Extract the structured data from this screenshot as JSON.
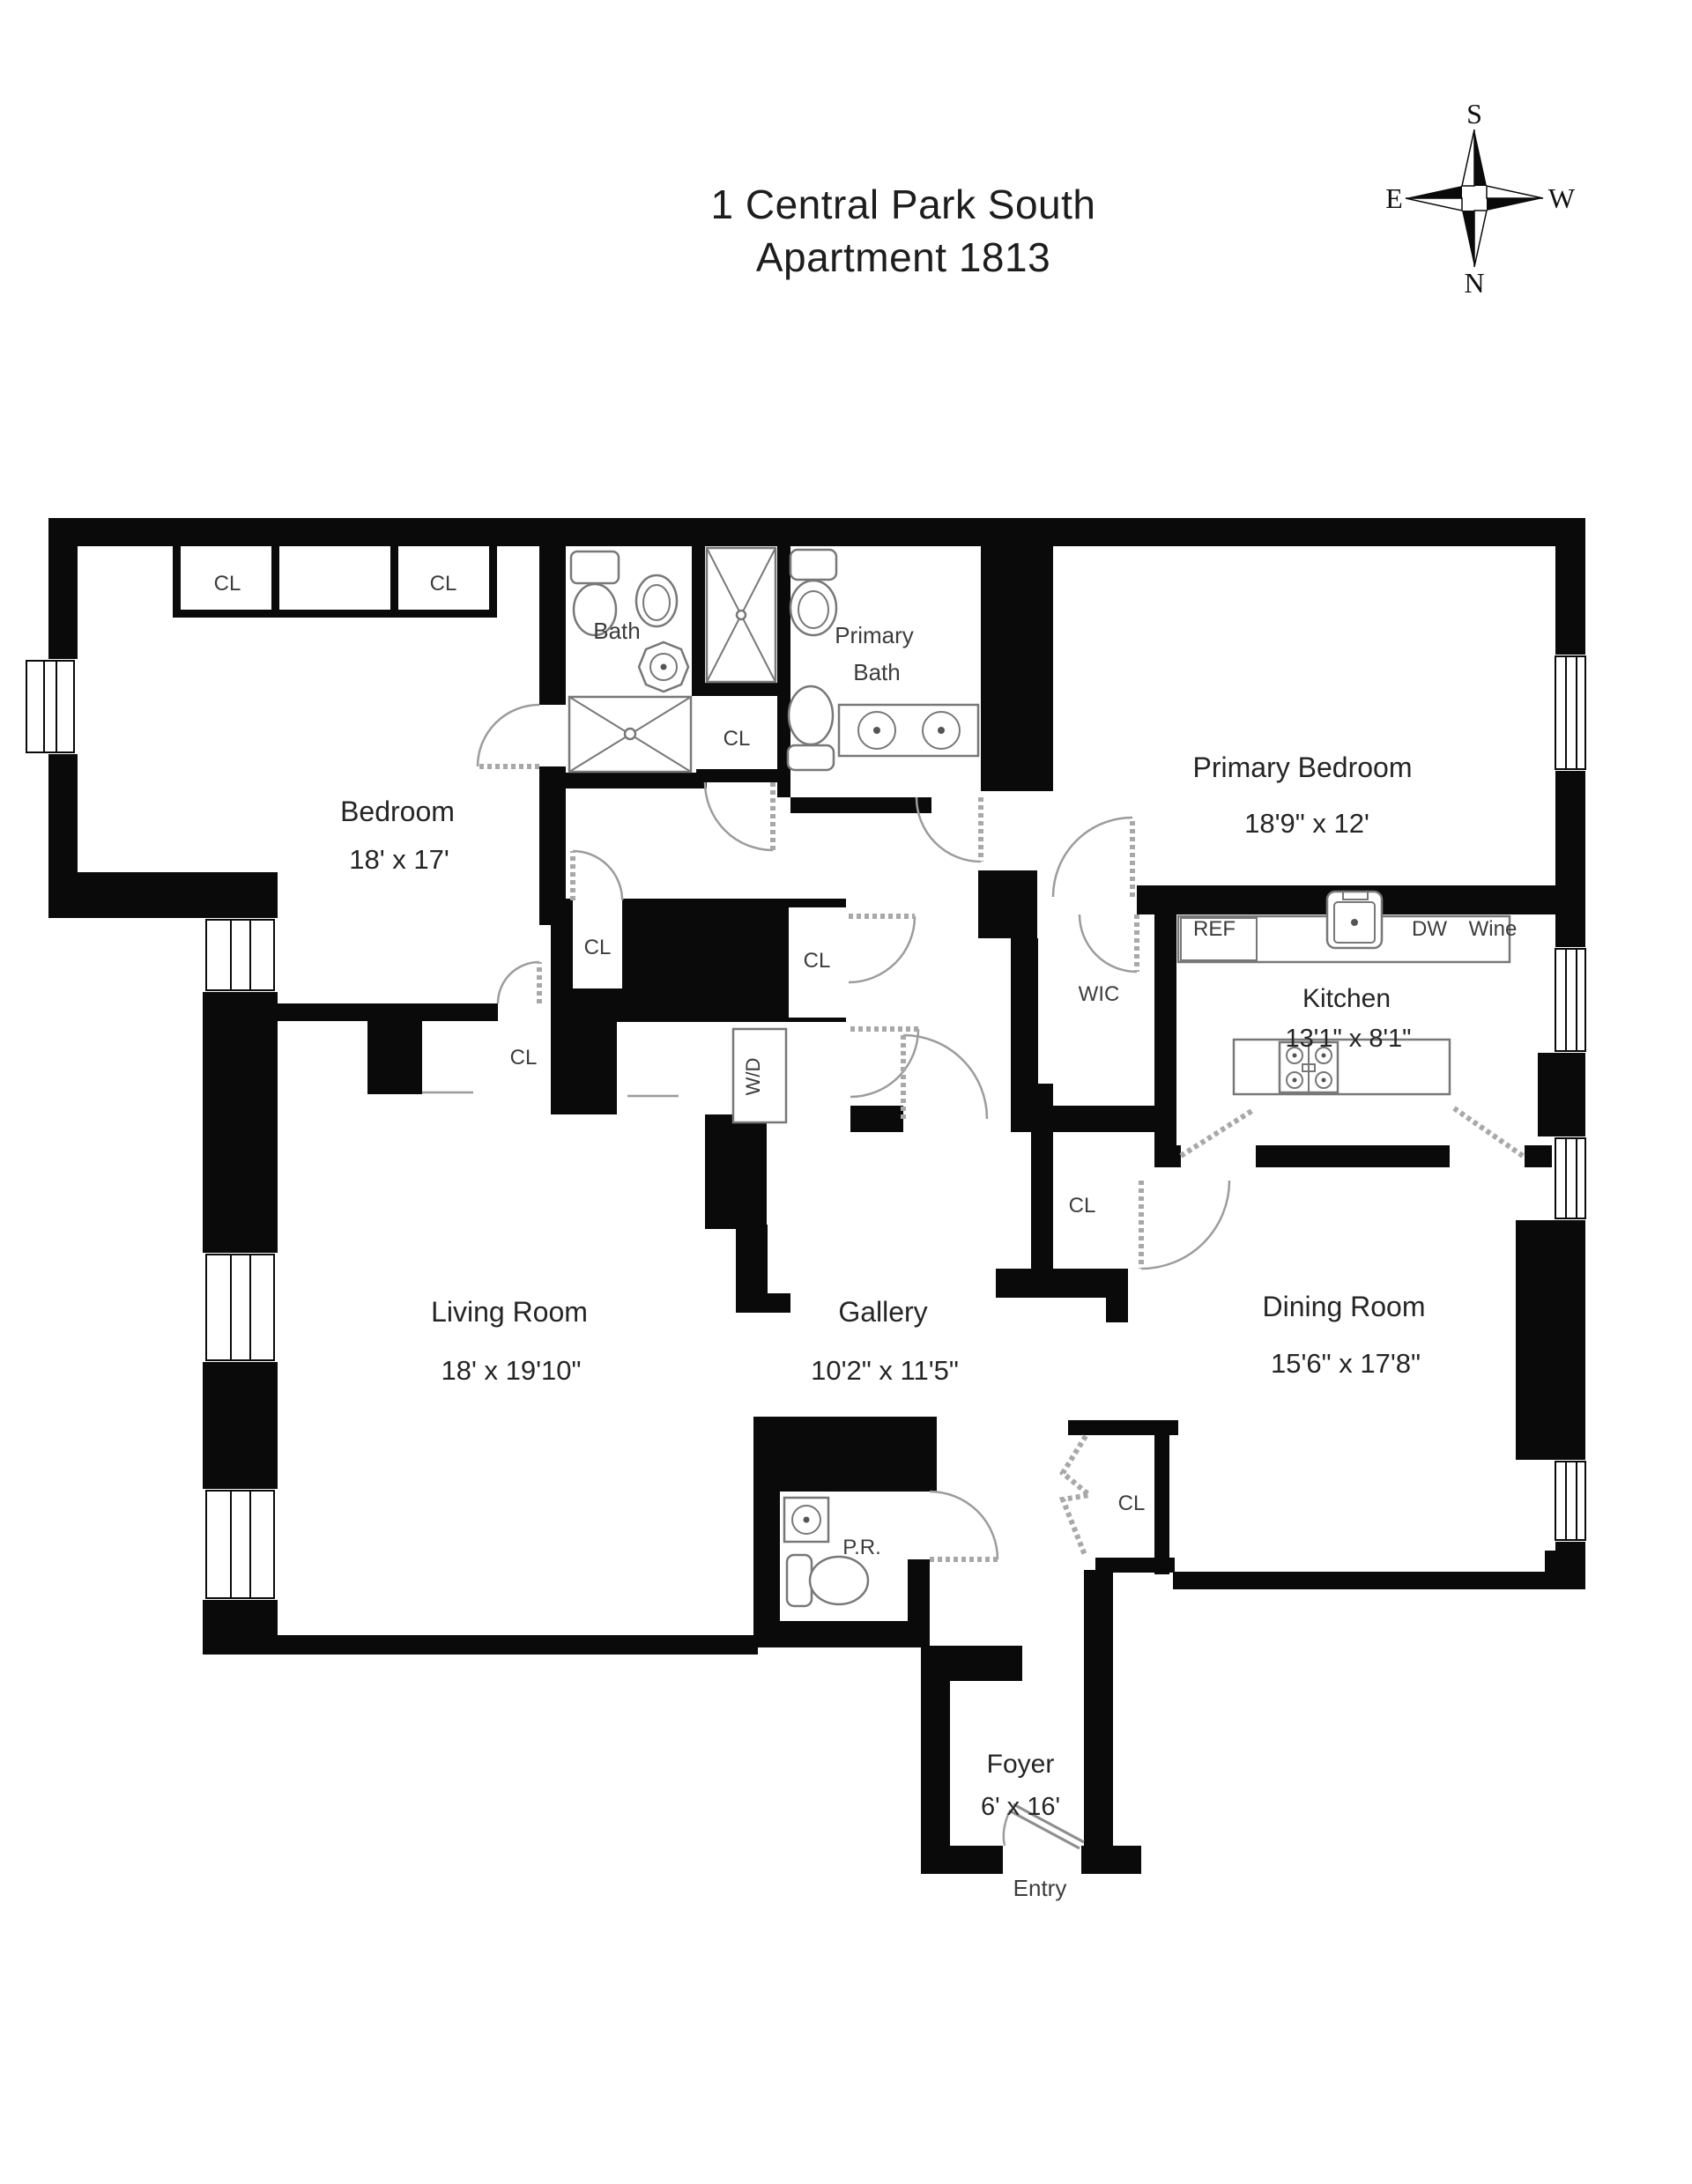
{
  "title": {
    "line1": "1 Central Park South",
    "line2": "Apartment 1813"
  },
  "compass": {
    "top": "S",
    "bottom": "N",
    "left": "E",
    "right": "W"
  },
  "rooms": {
    "bedroom": {
      "name": "Bedroom",
      "dims": "18' x 17'"
    },
    "primary_bedroom": {
      "name": "Primary Bedroom",
      "dims": "18'9\" x 12'"
    },
    "living_room": {
      "name": "Living Room",
      "dims": "18' x 19'10\""
    },
    "gallery": {
      "name": "Gallery",
      "dims": "10'2\" x 11'5\""
    },
    "dining_room": {
      "name": "Dining Room",
      "dims": "15'6\" x 17'8\""
    },
    "kitchen": {
      "name": "Kitchen",
      "dims": "13'1\" x 8'1\""
    },
    "foyer": {
      "name": "Foyer",
      "dims": "6' x 16'"
    },
    "bath": {
      "name": "Bath"
    },
    "primary_bath": {
      "line1": "Primary",
      "line2": "Bath"
    },
    "powder_room": {
      "name": "P.R."
    },
    "wic": {
      "name": "WIC"
    },
    "laundry": {
      "name": "W/D"
    }
  },
  "labels": {
    "closet": "CL",
    "entry": "Entry",
    "ref": "REF",
    "dw": "DW",
    "wine": "Wine"
  },
  "colors": {
    "wall": "#0a0a0a",
    "label": "#2b2b2b",
    "door_swing": "#9c9c9c",
    "fixture": "#787878",
    "background": "#ffffff"
  }
}
